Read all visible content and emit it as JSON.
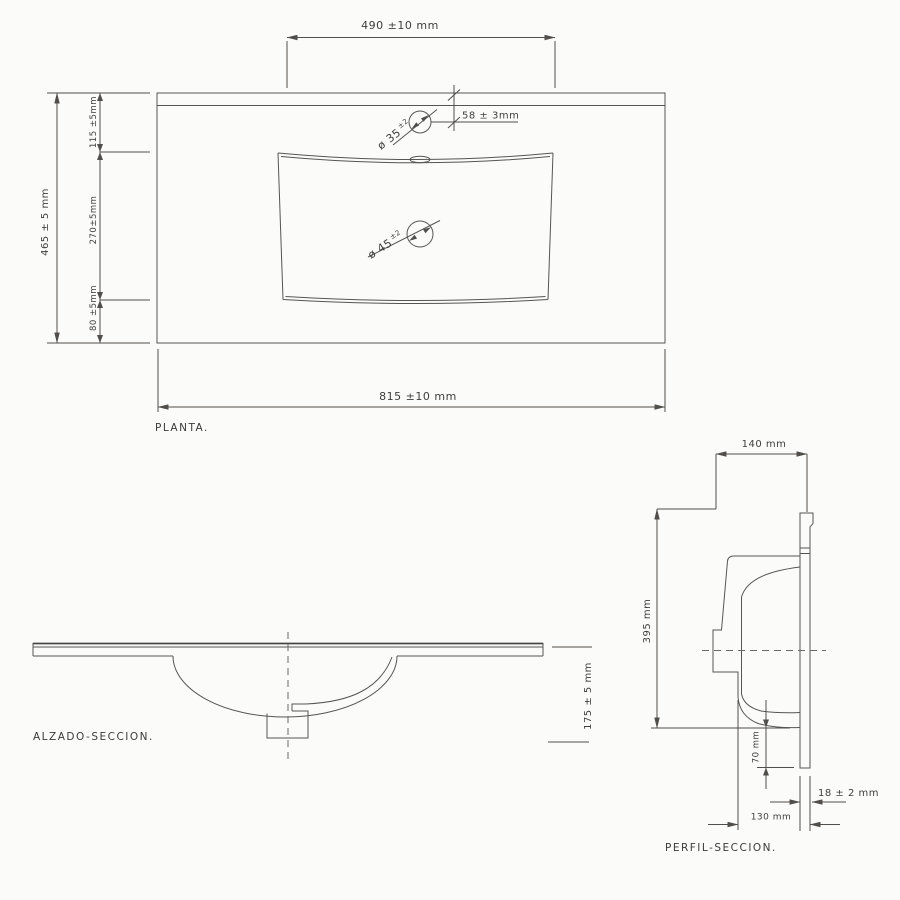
{
  "page": {
    "background": "#fbfbf9",
    "line_color": "#555552"
  },
  "planta": {
    "label": "PLANTA.",
    "dim_top_width": "490 ±10 mm",
    "dim_total_width": "815 ±10 mm",
    "dim_total_depth": "465 ± 5 mm",
    "dim_back_to_basin": "115 ±5mm",
    "dim_basin_depth": "270±5mm",
    "dim_basin_to_front": "80 ±5mm",
    "dim_faucet_center": "58 ± 3mm",
    "faucet_hole_diameter": "ø 35",
    "faucet_hole_tolerance": "±2",
    "drain_hole_diameter": "ø 45",
    "drain_hole_tolerance": "±2"
  },
  "alzado": {
    "label": "ALZADO-SECCION.",
    "dim_total_height": "175 ± 5 mm"
  },
  "perfil": {
    "label": "PERFIL-SECCION.",
    "dim_top_depth": "140 mm",
    "dim_height": "395 mm",
    "dim_drain_clearance": "70 mm",
    "dim_bottom_depth": "130 mm",
    "dim_thickness": "18 ± 2 mm"
  }
}
